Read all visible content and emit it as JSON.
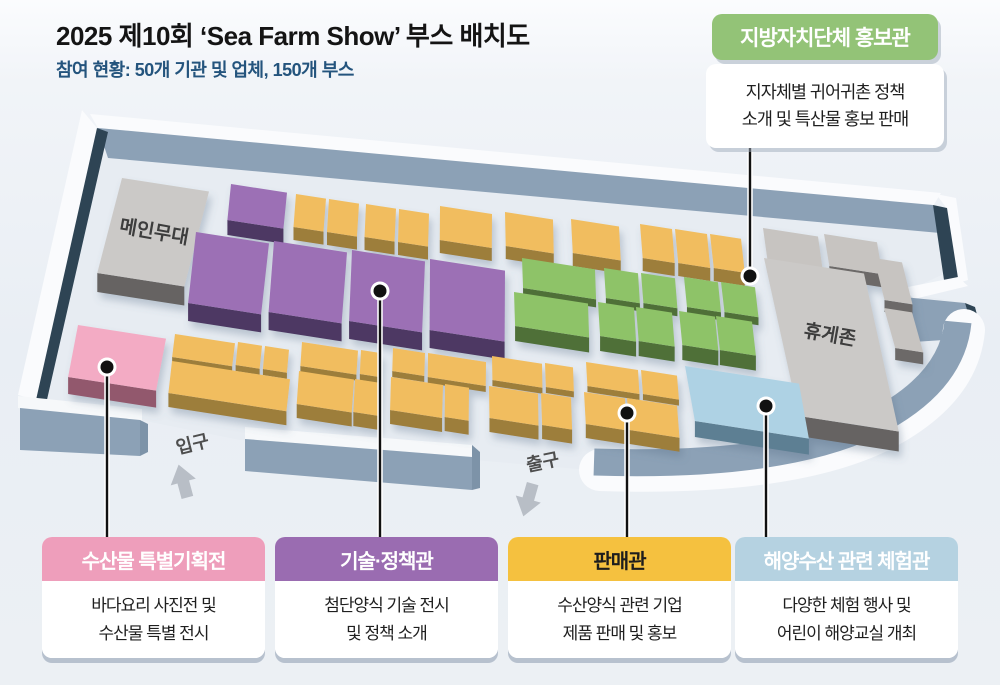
{
  "header": {
    "title": "2025 제10회 ‘Sea Farm Show’ 부스 배치도",
    "subtitle": "참여 현황: 50개 기관 및 업체, 150개 부스"
  },
  "info_box": {
    "title": "지방자치단체 홍보관",
    "line1": "지자체별 귀어귀촌 정책",
    "line2": "소개 및 특산물 홍보 판매",
    "color": "#93c377"
  },
  "legend": [
    {
      "title": "수산물 특별기획전",
      "line1": "바다요리 사진전 및",
      "line2": "수산물 특별 전시",
      "color": "#ee9ebb",
      "text_color": "#ffffff"
    },
    {
      "title": "기술·정책관",
      "line1": "첨단양식 기술 전시",
      "line2": "및 정책 소개",
      "color": "#9a6cb1",
      "text_color": "#ffffff"
    },
    {
      "title": "판매관",
      "line1": "수산양식 관련 기업",
      "line2": "제품 판매 및 홍보",
      "color": "#f5c13f",
      "text_color": "#1d1d1d"
    },
    {
      "title": "해양수산 관련 체험관",
      "line1": "다양한 체험 행사 및",
      "line2": "어린이 해양교실 개최",
      "color": "#b5d2e1",
      "text_color": "#ffffff"
    }
  ],
  "map": {
    "labels": {
      "main_stage": "메인무대",
      "rest_zone": "휴게존",
      "entrance": "입구",
      "exit": "출구"
    },
    "palette": {
      "yellow": {
        "top": "#F1BD5F",
        "side": "#9D7E3B"
      },
      "purple": {
        "top": "#9C70B5",
        "side": "#4D3963"
      },
      "green": {
        "top": "#8EC368",
        "side": "#507039"
      },
      "pink": {
        "top": "#F3ABC4",
        "side": "#92596D"
      },
      "blue": {
        "top": "#AED2E4",
        "side": "#5D7F93"
      },
      "gray": {
        "top": "#C7C4C1",
        "side": "#6C6967"
      },
      "gray2": {
        "top": "#CBC9C7",
        "side": "#666462"
      },
      "wall": "#8CA1B6",
      "wall_dark": "#2E4454",
      "trim": "#FAFBFD",
      "floor": "#E7ECF2"
    },
    "blocks": [
      {
        "x": 231,
        "y": 184,
        "w": 56,
        "h": 36,
        "c": "purple",
        "d": 15
      },
      {
        "x": 296,
        "y": 194,
        "w": 30,
        "h": 33,
        "c": "yellow",
        "d": 13
      },
      {
        "x": 329,
        "y": 199,
        "w": 30,
        "h": 33,
        "c": "yellow",
        "d": 13
      },
      {
        "x": 366,
        "y": 204,
        "w": 30,
        "h": 33,
        "c": "yellow",
        "d": 13
      },
      {
        "x": 399,
        "y": 209,
        "w": 30,
        "h": 33,
        "c": "yellow",
        "d": 13
      },
      {
        "x": 440,
        "y": 206,
        "w": 52,
        "h": 34,
        "c": "yellow",
        "d": 13
      },
      {
        "x": 505,
        "y": 212,
        "w": 48,
        "h": 34,
        "c": "yellow",
        "d": 13
      },
      {
        "x": 571,
        "y": 219,
        "w": 48,
        "h": 34,
        "c": "yellow",
        "d": 13
      },
      {
        "x": 640,
        "y": 224,
        "w": 32,
        "h": 34,
        "c": "yellow",
        "d": 13
      },
      {
        "x": 675,
        "y": 229,
        "w": 32,
        "h": 34,
        "c": "yellow",
        "d": 13
      },
      {
        "x": 710,
        "y": 234,
        "w": 31,
        "h": 34,
        "c": "yellow",
        "d": 13
      },
      {
        "x": 763,
        "y": 228,
        "w": 55,
        "h": 32,
        "c": "gray",
        "d": 13
      },
      {
        "x": 824,
        "y": 234,
        "w": 53,
        "h": 32,
        "c": "gray",
        "d": 13
      },
      {
        "x": 122,
        "y": 178,
        "w": 87,
        "h": 95,
        "c": "gray2",
        "d": 19,
        "lean": -0.26
      },
      {
        "x": 196,
        "y": 232,
        "w": 73,
        "h": 71,
        "c": "purple",
        "d": 18
      },
      {
        "x": 274,
        "y": 241,
        "w": 73,
        "h": 71,
        "c": "purple",
        "d": 18
      },
      {
        "x": 352,
        "y": 250,
        "w": 73,
        "h": 71,
        "c": "purple",
        "d": 18
      },
      {
        "x": 430,
        "y": 259,
        "w": 75,
        "h": 71,
        "c": "purple",
        "d": 18
      },
      {
        "x": 522,
        "y": 258,
        "w": 73,
        "h": 30,
        "c": "green",
        "d": 8
      },
      {
        "x": 514,
        "y": 292,
        "w": 74,
        "h": 34,
        "c": "green",
        "d": 15
      },
      {
        "x": 604,
        "y": 268,
        "w": 34,
        "h": 30,
        "c": "green",
        "d": 8
      },
      {
        "x": 641,
        "y": 273,
        "w": 34,
        "h": 30,
        "c": "green",
        "d": 8
      },
      {
        "x": 598,
        "y": 302,
        "w": 36,
        "h": 34,
        "c": "green",
        "d": 15
      },
      {
        "x": 636,
        "y": 307,
        "w": 36,
        "h": 34,
        "c": "green",
        "d": 15
      },
      {
        "x": 684,
        "y": 277,
        "w": 34,
        "h": 30,
        "c": "green",
        "d": 8
      },
      {
        "x": 721,
        "y": 282,
        "w": 34,
        "h": 30,
        "c": "green",
        "d": 8
      },
      {
        "x": 679,
        "y": 311,
        "w": 36,
        "h": 34,
        "c": "green",
        "d": 15
      },
      {
        "x": 716,
        "y": 316,
        "w": 36,
        "h": 34,
        "c": "green",
        "d": 15
      },
      {
        "x": 874,
        "y": 258,
        "w": 28,
        "h": 42,
        "c": "gray",
        "d": 12,
        "lean": 0.25
      },
      {
        "x": 884,
        "y": 308,
        "w": 28,
        "h": 40,
        "c": "gray",
        "d": 12,
        "lean": 0.28
      },
      {
        "x": 764,
        "y": 258,
        "w": 100,
        "h": 158,
        "c": "gray2",
        "d": 20,
        "lean": 0.22
      },
      {
        "x": 78,
        "y": 325,
        "w": 88,
        "h": 52,
        "c": "pink",
        "d": 17,
        "lean": -0.19
      },
      {
        "x": 175,
        "y": 334,
        "w": 60,
        "h": 23,
        "c": "yellow",
        "d": 6
      },
      {
        "x": 238,
        "y": 342,
        "w": 24,
        "h": 23,
        "c": "yellow",
        "d": 6
      },
      {
        "x": 265,
        "y": 346,
        "w": 24,
        "h": 23,
        "c": "yellow",
        "d": 6
      },
      {
        "x": 172,
        "y": 361,
        "w": 118,
        "h": 32,
        "c": "yellow",
        "d": 14
      },
      {
        "x": 302,
        "y": 342,
        "w": 56,
        "h": 24,
        "c": "yellow",
        "d": 6
      },
      {
        "x": 361,
        "y": 350,
        "w": 21,
        "h": 24,
        "c": "yellow",
        "d": 6
      },
      {
        "x": 299,
        "y": 371,
        "w": 55,
        "h": 33,
        "c": "yellow",
        "d": 14
      },
      {
        "x": 355,
        "y": 379,
        "w": 26,
        "h": 33,
        "c": "yellow",
        "d": 14
      },
      {
        "x": 393,
        "y": 348,
        "w": 32,
        "h": 23,
        "c": "yellow",
        "d": 6
      },
      {
        "x": 428,
        "y": 353,
        "w": 58,
        "h": 24,
        "c": "yellow",
        "d": 6
      },
      {
        "x": 391,
        "y": 377,
        "w": 52,
        "h": 33,
        "c": "yellow",
        "d": 14
      },
      {
        "x": 445,
        "y": 384,
        "w": 24,
        "h": 33,
        "c": "yellow",
        "d": 14
      },
      {
        "x": 492,
        "y": 356,
        "w": 50,
        "h": 24,
        "c": "yellow",
        "d": 6
      },
      {
        "x": 545,
        "y": 363,
        "w": 28,
        "h": 24,
        "c": "yellow",
        "d": 6
      },
      {
        "x": 489,
        "y": 386,
        "w": 49,
        "h": 32,
        "c": "yellow",
        "d": 14
      },
      {
        "x": 541,
        "y": 393,
        "w": 30,
        "h": 32,
        "c": "yellow",
        "d": 14
      },
      {
        "x": 586,
        "y": 362,
        "w": 52,
        "h": 24,
        "c": "yellow",
        "d": 6
      },
      {
        "x": 641,
        "y": 370,
        "w": 36,
        "h": 24,
        "c": "yellow",
        "d": 6
      },
      {
        "x": 584,
        "y": 392,
        "w": 41,
        "h": 32,
        "c": "yellow",
        "d": 14
      },
      {
        "x": 627,
        "y": 398,
        "w": 50,
        "h": 32,
        "c": "yellow",
        "d": 14
      },
      {
        "x": 685,
        "y": 366,
        "w": 114,
        "h": 55,
        "c": "blue",
        "d": 16,
        "lean": 0.18
      }
    ],
    "callouts": [
      {
        "x": 750,
        "y_dot": 276,
        "y_end": 148
      },
      {
        "x": 107,
        "y_dot": 367,
        "y_end": 539
      },
      {
        "x": 380,
        "y_dot": 291,
        "y_end": 539
      },
      {
        "x": 627,
        "y_dot": 413,
        "y_end": 539
      },
      {
        "x": 766,
        "y_dot": 406,
        "y_end": 539
      }
    ]
  }
}
